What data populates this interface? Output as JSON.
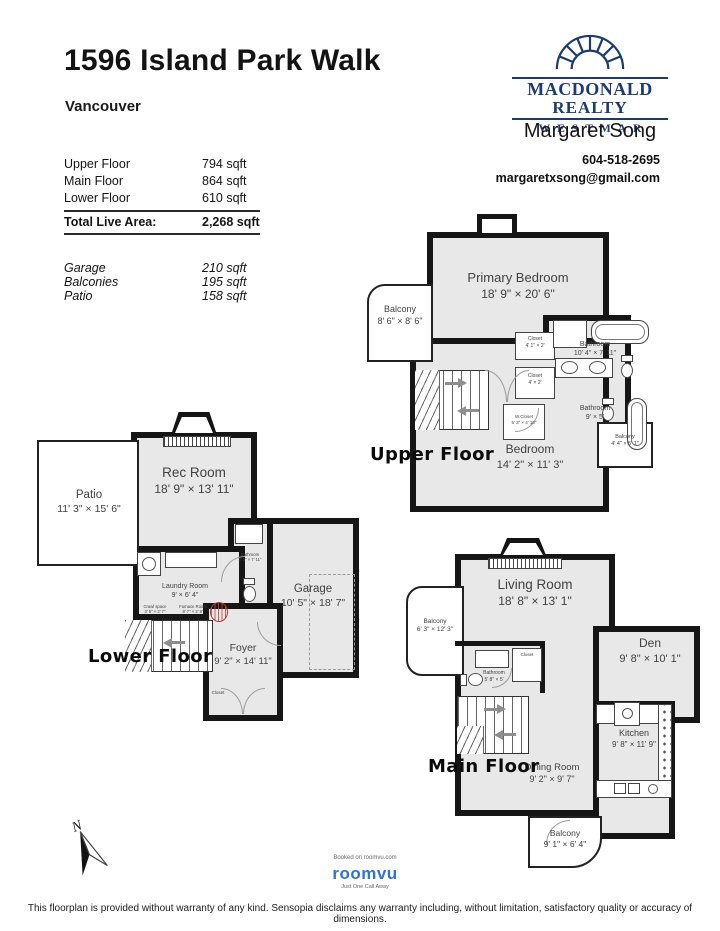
{
  "page": {
    "title": "1596 Island Park Walk",
    "city": "Vancouver",
    "disclaimer": "This floorplan is provided without warranty of any kind. Sensopia disclaims any warranty including, without limitation, satisfactory quality or accuracy of dimensions."
  },
  "logo": {
    "line1": "MACDONALD",
    "line2": "REALTY",
    "division": "WESTMAR",
    "navy": "#1d3c6e"
  },
  "agent": {
    "name": "Margaret Song",
    "phone": "604-518-2695",
    "email": "margaretxsong@gmail.com"
  },
  "areas": {
    "rows": [
      {
        "label": "Upper Floor",
        "value": "794 sqft"
      },
      {
        "label": "Main Floor",
        "value": "864 sqft"
      },
      {
        "label": "Lower Floor",
        "value": "610 sqft"
      }
    ],
    "total_label": "Total Live Area:",
    "total_value": "2,268 sqft",
    "extra": [
      {
        "label": "Garage",
        "value": "210 sqft"
      },
      {
        "label": "Balconies",
        "value": "195 sqft"
      },
      {
        "label": "Patio",
        "value": "158 sqft"
      }
    ]
  },
  "floors": {
    "upper": {
      "title": "Upper Floor",
      "rooms": {
        "balcony_nw": {
          "name": "Balcony",
          "dims": "8' 6\" × 8' 6\""
        },
        "primary": {
          "name": "Primary Bedroom",
          "dims": "18' 9\" × 20' 6\""
        },
        "closet_a": {
          "name": "Closet",
          "dims": "4' 1\" × 2'"
        },
        "closet_b": {
          "name": "Closet",
          "dims": "4' × 2'"
        },
        "bath_a": {
          "name": "Bathroom",
          "dims": "10' 4\" × 7' 11\""
        },
        "wcloset": {
          "name": "W.Closet",
          "dims": "5' 3\" × 4' 10\""
        },
        "bath_b": {
          "name": "Bathroom",
          "dims": "9' × 5'"
        },
        "bedroom": {
          "name": "Bedroom",
          "dims": "14' 2\" × 11' 3\""
        },
        "balcony_e": {
          "name": "Balcony",
          "dims": "4' 4\" × 5' 1\""
        }
      }
    },
    "lower": {
      "title": "Lower Floor",
      "rooms": {
        "patio": {
          "name": "Patio",
          "dims": "11' 3\" × 15' 6\""
        },
        "rec": {
          "name": "Rec Room",
          "dims": "18' 9\" × 13' 11\""
        },
        "laundry": {
          "name": "Laundry Room",
          "dims": "9' × 6' 4\""
        },
        "bath": {
          "name": "Bathroom",
          "dims": "2' 2\" × 7' 11\""
        },
        "garage": {
          "name": "Garage",
          "dims": "10' 5\" × 18' 7\""
        },
        "crawl": {
          "name": "Crawl space",
          "dims": "3' 5\" × 2' 7\""
        },
        "furnace": {
          "name": "Furnace Room",
          "dims": "8' 7\" × 2' 8\""
        },
        "foyer": {
          "name": "Foyer",
          "dims": "9' 2\" × 14' 11\""
        },
        "closet": {
          "name": "Closet"
        }
      }
    },
    "main": {
      "title": "Main Floor",
      "rooms": {
        "living": {
          "name": "Living Room",
          "dims": "18' 8\" × 13' 1\""
        },
        "balcony_w": {
          "name": "Balcony",
          "dims": "6' 3\" × 12' 3\""
        },
        "den": {
          "name": "Den",
          "dims": "9' 8\" × 10' 1\""
        },
        "bath": {
          "name": "Bathroom",
          "dims": "5' 8\" × 5'"
        },
        "closet": {
          "name": "Closet"
        },
        "kitchen": {
          "name": "Kitchen",
          "dims": "9' 8\" × 11' 9\""
        },
        "dining": {
          "name": "Dining Room",
          "dims": "9' 2\" × 9' 7\""
        },
        "balcony_s": {
          "name": "Balcony",
          "dims": "9' 1\" × 6' 4\""
        }
      }
    }
  },
  "compass": {
    "label": "N"
  },
  "brand": {
    "booked": "Booked on roomvu.com",
    "name": "roomvu",
    "tagline": "Just One Call Away",
    "blue": "#2f72d9"
  }
}
